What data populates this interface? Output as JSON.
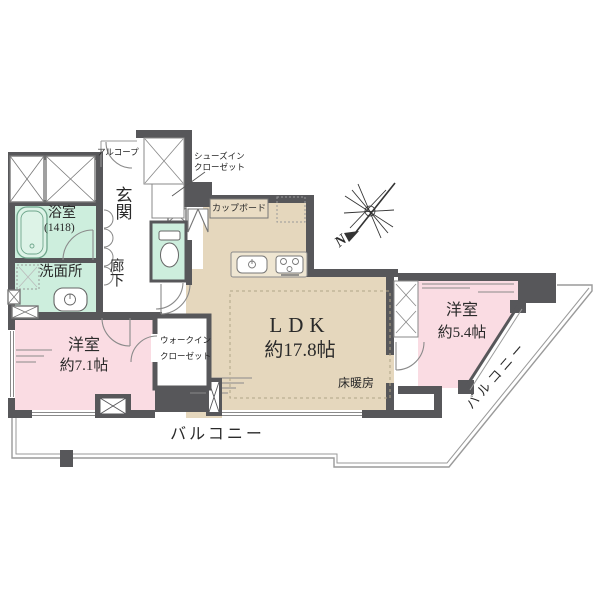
{
  "floorplan": {
    "type": "apartment-floorplan",
    "compass": {
      "label": "N"
    },
    "colors": {
      "wall": "#57575a",
      "ldk_floor": "#e5d7bd",
      "bedroom_floor": "#fadce3",
      "wet_area_floor": "#cdeedd",
      "balcony_line": "#9a9a9a",
      "counter": "#efe6d2"
    },
    "rooms": {
      "ldk": {
        "name": "LDK",
        "size": "約17.8帖",
        "feature": "床暖房"
      },
      "bedroom1": {
        "name": "洋室",
        "size": "約7.1帖"
      },
      "bedroom2": {
        "name": "洋室",
        "size": "約5.4帖"
      },
      "bathroom": {
        "name": "浴室",
        "size": "(1418)"
      },
      "washroom": {
        "name": "洗面所"
      },
      "entrance": {
        "name": "玄関"
      },
      "hallway": {
        "name": "廊下"
      },
      "wic": {
        "line1": "ウォークイン",
        "line2": "クローゼット"
      },
      "sic": {
        "line1": "シューズイン",
        "line2": "クローゼット"
      },
      "alcove": {
        "name": "アルコープ"
      },
      "cupboard": {
        "name": "カップボード"
      },
      "balcony_south": {
        "name": "バルコニー"
      },
      "balcony_east": {
        "name": "バルコニー"
      }
    }
  }
}
